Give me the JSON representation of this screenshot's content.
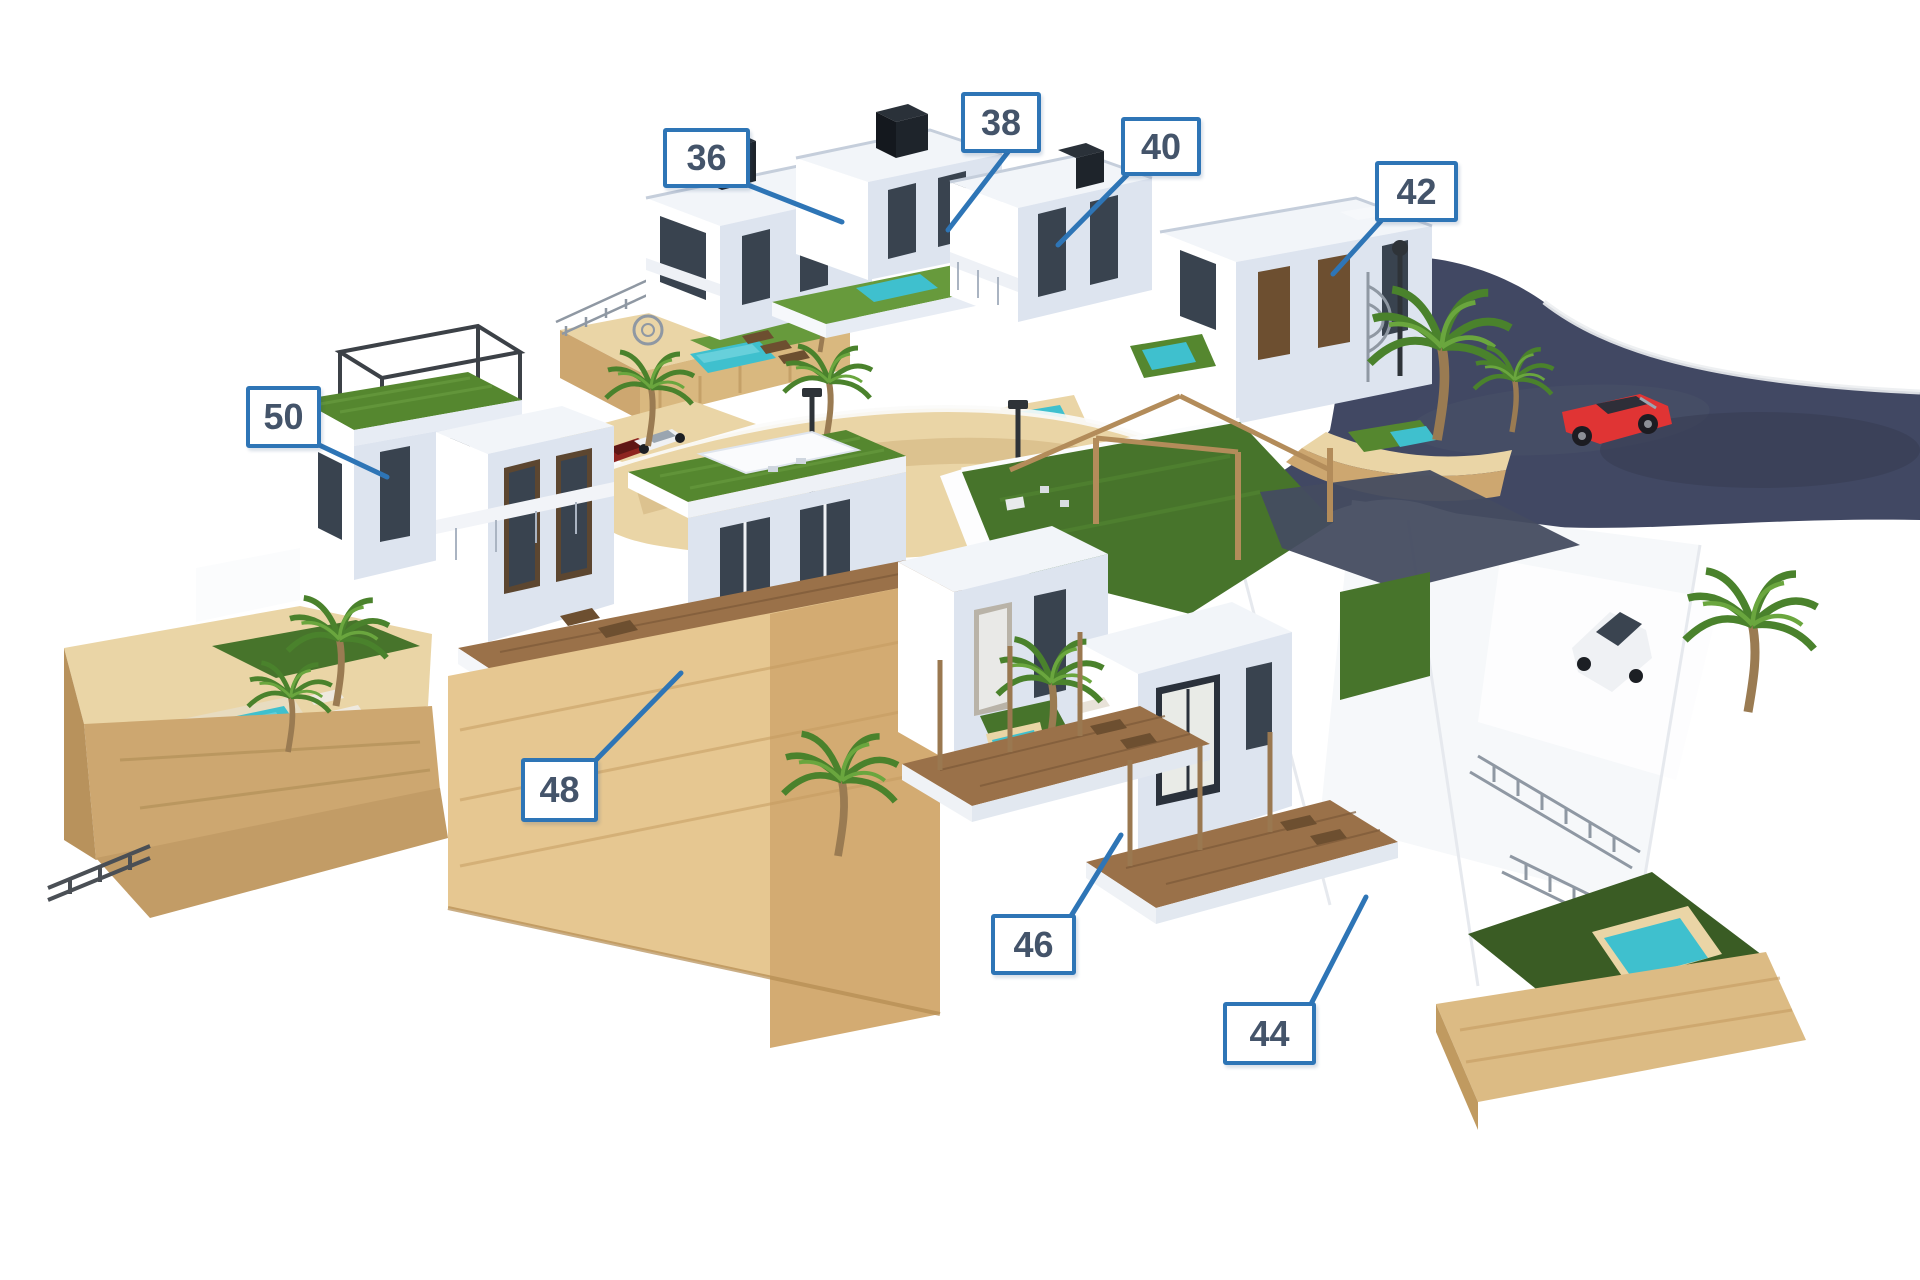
{
  "callouts": [
    {
      "number": "36"
    },
    {
      "number": "38"
    },
    {
      "number": "40"
    },
    {
      "number": "42"
    },
    {
      "number": "44"
    },
    {
      "number": "46"
    },
    {
      "number": "48"
    },
    {
      "number": "50"
    }
  ],
  "colors": {
    "label_border": "#2e75b6",
    "label_text": "#44546a",
    "road": "#414863",
    "sand": "#ead5a6",
    "sand_dark": "#cda770",
    "sand_deep": "#b8925c",
    "grass": "#55872f",
    "grass_light": "#679a3c",
    "grass_dark": "#47742b",
    "grass_deep": "#3a5c24",
    "pool": "#3fc0ce",
    "building": "#ffffff",
    "building_shade": "#dde4ef",
    "glass": "#39434f",
    "wood_deck": "#9a7149",
    "wood_dark": "#6d4f30",
    "palm_green": "#4a822c",
    "palm_light": "#6aa63e",
    "trunk": "#9a7b52",
    "car_red": "#e03434",
    "car_white": "#eff1f4",
    "metal": "#8f98a3",
    "lamp": "#2e3338"
  }
}
